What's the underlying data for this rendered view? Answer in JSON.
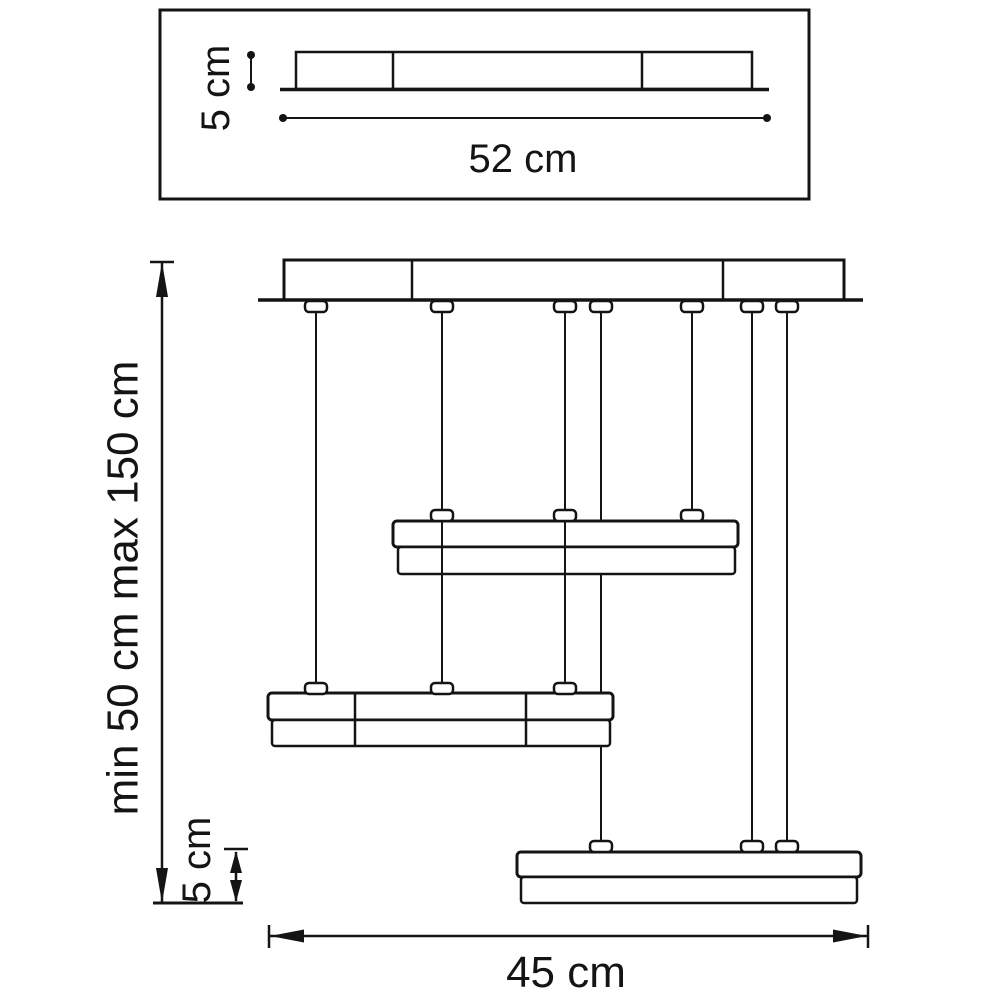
{
  "colors": {
    "line": "#141414",
    "background": "#ffffff"
  },
  "top_view": {
    "height_label": "5 cm",
    "length_label": "52 cm"
  },
  "front_view": {
    "suspension_label": "min 50 cm max 150 cm",
    "shade_height_label": "5 cm",
    "width_label": "45 cm"
  },
  "values": {
    "canopy_length_cm": 52,
    "canopy_height_cm": 5,
    "suspension_min_cm": 50,
    "suspension_max_cm": 150,
    "shade_height_cm": 5,
    "fixture_width_cm": 45
  }
}
